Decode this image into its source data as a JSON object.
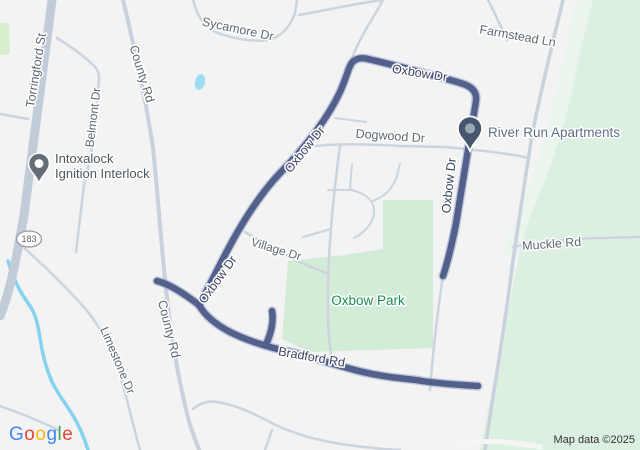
{
  "canvas": {
    "width": 640,
    "height": 450
  },
  "attribution": {
    "map_data": "Map data ©2025"
  },
  "logo": {
    "letters": [
      {
        "ch": "G",
        "color": "#4285F4"
      },
      {
        "ch": "o",
        "color": "#EA4335"
      },
      {
        "ch": "o",
        "color": "#FBBC05"
      },
      {
        "ch": "g",
        "color": "#4285F4"
      },
      {
        "ch": "l",
        "color": "#34A853"
      },
      {
        "ch": "e",
        "color": "#EA4335"
      }
    ]
  },
  "route_shield": {
    "number": "183",
    "cx": 29,
    "cy": 239
  },
  "colors": {
    "bg": "#f2f3f2",
    "route": "#53608c",
    "route_casing": "#9ca8c9",
    "road_minor": "#ccd4de",
    "road_medium": "#c9d1dc",
    "road_major": "#c2ccd8",
    "road_white": "#f5f6f4",
    "park": "#d3ecd8",
    "forest": "#dcf0e2",
    "forest_pale": "#eaf5ee",
    "grass": "#d9eecd",
    "water": "#85d2ee",
    "pond": "#9edcf2",
    "label_road": "#5f6873",
    "label_route": "#3a4460",
    "label_park": "#1a8c52",
    "label_poi_blue": "#5e7089",
    "label_poi_dark": "#4d565f",
    "pin_river_body": "#47566d",
    "pin_river_inner": "#9aa6b5",
    "pin_intox_body": "#656e78",
    "pin_intox_inner": "#ffffff",
    "shield_border": "#959ba3",
    "shield_text": "#5c6269"
  },
  "map_labels": [
    {
      "id": "torringford-st",
      "text": "Torringford St",
      "x": 40,
      "y": 71,
      "rot": -81,
      "cls": "road",
      "size": 12.5,
      "interactable": false
    },
    {
      "id": "county-rd-upper",
      "text": "County Rd",
      "x": 138,
      "y": 75,
      "rot": 73,
      "cls": "road",
      "size": 12.5,
      "interactable": false
    },
    {
      "id": "belmont-dr",
      "text": "Belmont Dr",
      "x": 97,
      "y": 118,
      "rot": -83,
      "cls": "road",
      "size": 12,
      "interactable": false
    },
    {
      "id": "sycamore-dr",
      "text": "Sycamore Dr",
      "x": 237,
      "y": 33,
      "rot": 12,
      "cls": "road",
      "size": 12.5,
      "interactable": false
    },
    {
      "id": "farmstead-ln",
      "text": "Farmstead Ln",
      "x": 517,
      "y": 40,
      "rot": 10,
      "cls": "road",
      "size": 12.5,
      "interactable": false
    },
    {
      "id": "dogwood-dr",
      "text": "Dogwood Dr",
      "x": 390,
      "y": 140,
      "rot": 4,
      "cls": "road",
      "size": 12.5,
      "interactable": false
    },
    {
      "id": "oxbow-dr-top",
      "text": "Oxbow Dr",
      "x": 419,
      "y": 77,
      "rot": 9,
      "cls": "route",
      "size": 12.5,
      "interactable": false
    },
    {
      "id": "oxbow-dr-upper",
      "text": "Oxbow Dr",
      "x": 308,
      "y": 152,
      "rot": -51,
      "cls": "route",
      "size": 12.5,
      "interactable": false
    },
    {
      "id": "oxbow-dr-right",
      "text": "Oxbow Dr",
      "x": 453,
      "y": 186,
      "rot": -84,
      "cls": "route",
      "size": 12.5,
      "interactable": false
    },
    {
      "id": "oxbow-dr-lower",
      "text": "Oxbow Dr",
      "x": 221,
      "y": 282,
      "rot": -54,
      "cls": "route",
      "size": 12.5,
      "interactable": false
    },
    {
      "id": "county-rd-lower",
      "text": "County Rd",
      "x": 165,
      "y": 330,
      "rot": 76,
      "cls": "road",
      "size": 12.5,
      "interactable": false
    },
    {
      "id": "limestone-dr",
      "text": "Limestone Dr",
      "x": 114,
      "y": 362,
      "rot": 67,
      "cls": "road",
      "size": 12,
      "interactable": false
    },
    {
      "id": "village-dr",
      "text": "Village Dr",
      "x": 275,
      "y": 253,
      "rot": 17,
      "cls": "road",
      "size": 12,
      "interactable": false
    },
    {
      "id": "muckle-rd",
      "text": "Muckle Rd",
      "x": 552,
      "y": 248,
      "rot": -4,
      "cls": "road",
      "size": 12.5,
      "interactable": false
    },
    {
      "id": "bradford-rd",
      "text": "Bradford Rd",
      "x": 311,
      "y": 361,
      "rot": 10,
      "cls": "route",
      "size": 12.5,
      "interactable": false
    },
    {
      "id": "oxbow-park",
      "text": "Oxbow Park",
      "x": 368,
      "y": 305,
      "rot": 0,
      "cls": "park",
      "size": 13.5,
      "interactable": true
    },
    {
      "id": "river-run-apartments",
      "text": "River Run Apartments",
      "x": 488,
      "y": 137,
      "rot": 0,
      "cls": "poi-blue",
      "size": 13.5,
      "anchor": "start",
      "interactable": true
    },
    {
      "id": "intoxalock-line1",
      "text": "Intoxalock",
      "x": 55,
      "y": 163,
      "rot": 0,
      "cls": "poi-dark",
      "size": 13,
      "anchor": "start",
      "interactable": true
    },
    {
      "id": "intoxalock-line2",
      "text": "Ignition Interlock",
      "x": 55,
      "y": 178,
      "rot": 0,
      "cls": "poi-dark",
      "size": 13,
      "anchor": "start",
      "interactable": true
    }
  ],
  "pins": [
    {
      "id": "intoxalock-pin",
      "x": 39,
      "y": 183,
      "scale": 0.95,
      "body_key": "pin_intox_body",
      "inner_key": "pin_intox_inner"
    },
    {
      "id": "river-run-apartments-pin",
      "x": 470,
      "y": 151,
      "scale": 1.1,
      "body_key": "pin_river_body",
      "inner_key": "pin_river_inner"
    }
  ]
}
